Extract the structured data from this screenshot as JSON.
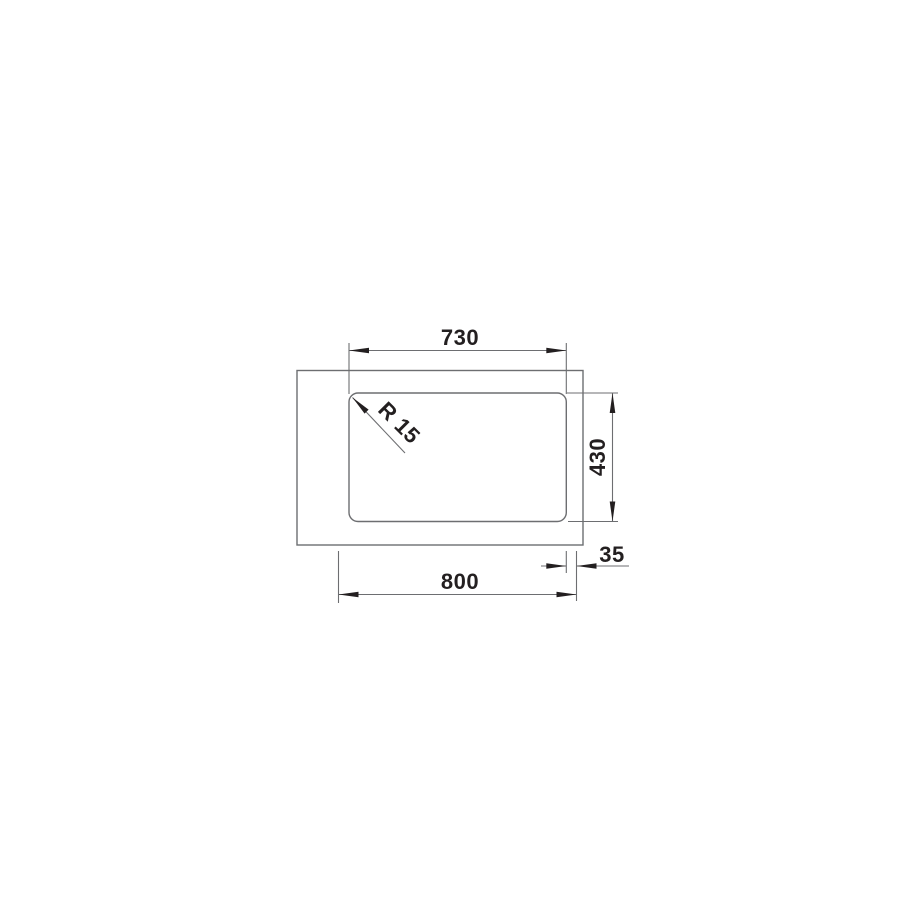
{
  "drawing": {
    "kind": "technical-dimension-drawing",
    "view": "top-view sink bowl in countertop",
    "colors": {
      "background": "#ffffff",
      "line": "#6d6e71",
      "emphasis": "#231f20"
    },
    "labels": {
      "bowl_width": "730",
      "bowl_depth": "430",
      "overall_width": "800",
      "edge_offset": "35",
      "corner_radius": "R 15"
    },
    "dimensions_mm": {
      "bowl_width": 730,
      "bowl_depth": 430,
      "overall_width": 800,
      "edge_offset": 35,
      "corner_radius": 15
    }
  }
}
